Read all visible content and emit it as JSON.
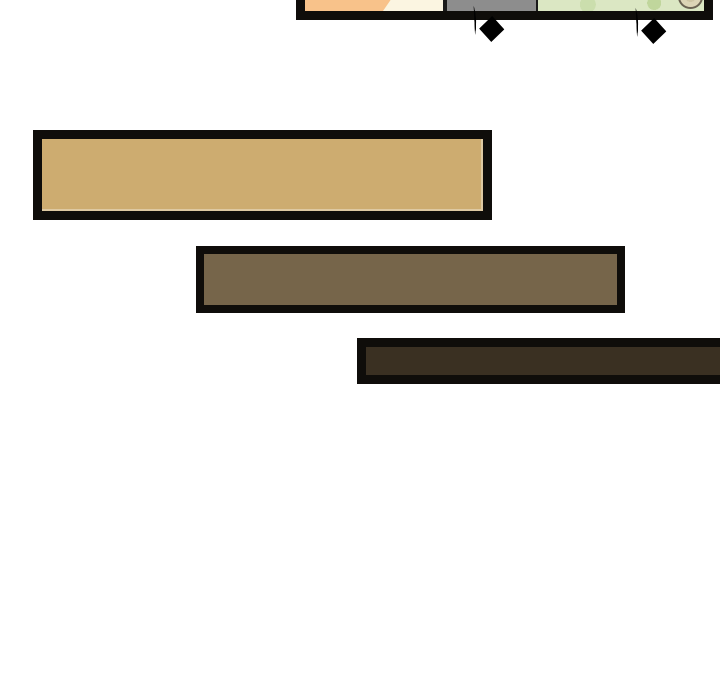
{
  "page": {
    "type": "comic-strip-segment",
    "background": "#ffffff"
  },
  "colors": {
    "page-bg": "#ffffff",
    "panel-border": "#0f0d0a",
    "panel-bg": "#fbf5e1",
    "orange": "#f8c28a",
    "gray-head": "#8d8d8d",
    "green-base": "#dbe7c3",
    "pink-flower": "#ecc0d2",
    "beige-dish": "#ddd5b6",
    "sfx-ink": "#0c0a08",
    "bar-border": "#0f0d0a",
    "bar1-fill": "#cdac70",
    "bar2-fill": "#76654a",
    "bar3-fill": "#3a3022"
  },
  "panel": {
    "description": "bottom sliver of a comic panel: orange figure, cream wall, gray head silhouette, green hedge with pink flowers, round beige dish"
  },
  "sfx": [
    {
      "text": "砰",
      "meaning": "bang sound effect"
    },
    {
      "text": "砰",
      "meaning": "bang sound effect"
    }
  ],
  "bars": [
    {
      "name": "tan-bar",
      "fill": "#cdac70"
    },
    {
      "name": "taupe-brown-bar",
      "fill": "#76654a"
    },
    {
      "name": "dark-brown-bar",
      "fill": "#3a3022"
    }
  ]
}
